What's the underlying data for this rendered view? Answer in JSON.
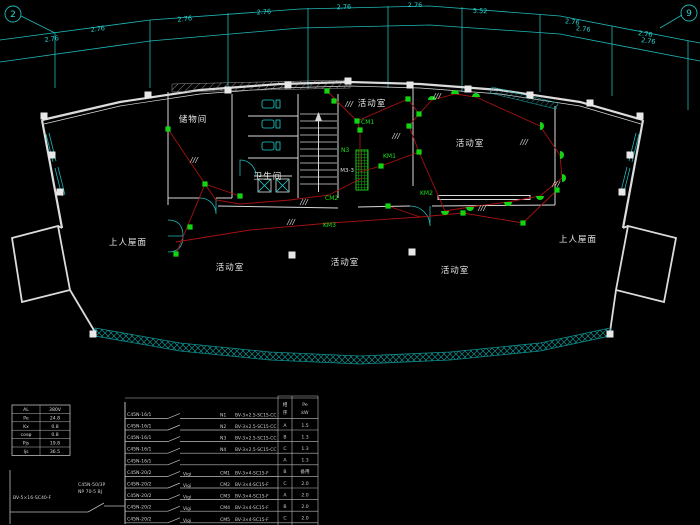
{
  "title": "electrical-floor-plan-cad-drawing",
  "colors": {
    "background": "#000000",
    "walls": "#dcdcdc",
    "dimensions": "#27d3d3",
    "fixtures_and_circuit_labels": "#17e017",
    "wiring": "#a61212",
    "glass_hatch": "#0e8f8f"
  },
  "legend": {
    "ceiling-light-icon": "small green filled square",
    "wall-light-icon": "green filled semicircle",
    "distribution-box-icon": "green hatched rectangle",
    "wire": "red polyline",
    "column-icon": "small white filled square"
  },
  "axes": {
    "left_bubble": "2",
    "right_bubble": "9"
  },
  "dimensions": {
    "upper": [
      {
        "t": "2.76",
        "x": 98,
        "y": 31,
        "r": -8
      },
      {
        "t": "2.76",
        "x": 185,
        "y": 21,
        "r": -6
      },
      {
        "t": "2.76",
        "x": 264,
        "y": 14,
        "r": -4
      },
      {
        "t": "2.76",
        "x": 344,
        "y": 9,
        "r": -2
      },
      {
        "t": "2.76",
        "x": 415,
        "y": 7,
        "r": 0
      },
      {
        "t": "5.52",
        "x": 480,
        "y": 13,
        "r": 3
      },
      {
        "t": "2.76",
        "x": 572,
        "y": 24,
        "r": 6
      },
      {
        "t": "2.76",
        "x": 645,
        "y": 36,
        "r": 8
      }
    ],
    "lower": [
      {
        "t": "2.76",
        "x": 52,
        "y": 41,
        "r": -8
      },
      {
        "t": "2.76",
        "x": 583,
        "y": 31,
        "r": 6
      },
      {
        "t": "2.76",
        "x": 648,
        "y": 43,
        "r": 8
      }
    ]
  },
  "rooms": [
    {
      "name": "storage-room",
      "label": "储物间",
      "x": 193,
      "y": 122
    },
    {
      "name": "bathroom",
      "label": "卫生间",
      "x": 268,
      "y": 179
    },
    {
      "name": "activity-room-1",
      "label": "活动室",
      "x": 372,
      "y": 106
    },
    {
      "name": "activity-room-2",
      "label": "活动室",
      "x": 470,
      "y": 146
    },
    {
      "name": "activity-room-3",
      "label": "活动室",
      "x": 230,
      "y": 270
    },
    {
      "name": "activity-room-4",
      "label": "活动室",
      "x": 345,
      "y": 265
    },
    {
      "name": "activity-room-5",
      "label": "活动室",
      "x": 455,
      "y": 273
    },
    {
      "name": "roof-terrace-left",
      "label": "上人屋面",
      "x": 128,
      "y": 245
    },
    {
      "name": "roof-terrace-right",
      "label": "上人屋面",
      "x": 578,
      "y": 242
    }
  ],
  "plan_circuit_labels": [
    {
      "label": "CM1",
      "x": 361,
      "y": 124
    },
    {
      "label": "KM1",
      "x": 383,
      "y": 158
    },
    {
      "label": "N3",
      "x": 341,
      "y": 152
    },
    {
      "label": "KM2",
      "x": 420,
      "y": 195
    },
    {
      "label": "CM2",
      "x": 325,
      "y": 200
    },
    {
      "label": "KM3",
      "x": 323,
      "y": 227
    }
  ],
  "panel_box_label": "M3-3",
  "load_table": {
    "rows": [
      [
        "AL",
        "380V"
      ],
      [
        "Pe",
        "24.8"
      ],
      [
        "Kx",
        "0.8"
      ],
      [
        "cosφ",
        "0.8"
      ],
      [
        "Pjs",
        "19.8"
      ],
      [
        "Ijs",
        "36.5"
      ]
    ]
  },
  "panel_schedule": {
    "main_breaker_line1": "C45N-50/3P",
    "main_breaker_line2": "NP 70-5 BJ",
    "incoming_cable": "BV-5×16-SC40-F",
    "header_phase_1": "相",
    "header_phase_2": "序",
    "header_pe": "Pe",
    "header_pe_unit": "kW",
    "branches": [
      {
        "breaker": "C45N-16/1",
        "rcd": "",
        "id": "N1",
        "wire": "BV-3×2.5-SC15-CC",
        "phase": "A",
        "pe": "1.5"
      },
      {
        "breaker": "C45N-16/1",
        "rcd": "",
        "id": "N2",
        "wire": "BV-3×2.5-SC15-CC",
        "phase": "B",
        "pe": "1.3"
      },
      {
        "breaker": "C45N-16/1",
        "rcd": "",
        "id": "N3",
        "wire": "BV-3×2.5-SC15-CC",
        "phase": "C",
        "pe": "1.3"
      },
      {
        "breaker": "C45N-16/1",
        "rcd": "",
        "id": "N4",
        "wire": "BV-3×2.5-SC15-CC",
        "phase": "A",
        "pe": "1.3"
      },
      {
        "breaker": "C45N-16/1",
        "rcd": "",
        "id": "",
        "wire": "",
        "phase": "B",
        "pe": "备用"
      },
      {
        "breaker": "C45N-20/2",
        "rcd": "Vigi",
        "id": "CM1",
        "wire": "BV-3×4-SC15-F",
        "phase": "C",
        "pe": "2.0"
      },
      {
        "breaker": "C45N-20/2",
        "rcd": "Vigi",
        "id": "CM2",
        "wire": "BV-3×4-SC15-F",
        "phase": "A",
        "pe": "2.0"
      },
      {
        "breaker": "C45N-20/2",
        "rcd": "Vigi",
        "id": "CM3",
        "wire": "BV-3×4-SC15-F",
        "phase": "B",
        "pe": "2.0"
      },
      {
        "breaker": "C45N-20/2",
        "rcd": "Vigi",
        "id": "CM4",
        "wire": "BV-3×4-SC15-F",
        "phase": "C",
        "pe": "2.0"
      },
      {
        "breaker": "C45N-20/2",
        "rcd": "Vigi",
        "id": "CM5",
        "wire": "BV-3×4-SC15-F",
        "phase": "A",
        "pe": "2.0"
      }
    ]
  },
  "fixtures": {
    "ceiling": [
      [
        168,
        129
      ],
      [
        205,
        184
      ],
      [
        240,
        196
      ],
      [
        327,
        91
      ],
      [
        334,
        101
      ],
      [
        357,
        121
      ],
      [
        360,
        130
      ],
      [
        408,
        99
      ],
      [
        419,
        114
      ],
      [
        409,
        126
      ],
      [
        419,
        152
      ],
      [
        381,
        166
      ],
      [
        388,
        206
      ],
      [
        463,
        213
      ],
      [
        523,
        223
      ],
      [
        190,
        227
      ],
      [
        176,
        254
      ],
      [
        557,
        190
      ]
    ],
    "wall": [
      [
        432,
        100,
        0
      ],
      [
        455,
        94,
        0
      ],
      [
        476,
        97,
        0
      ],
      [
        540,
        126,
        90
      ],
      [
        560,
        155,
        90
      ],
      [
        562,
        178,
        90
      ],
      [
        540,
        196,
        180
      ],
      [
        508,
        202,
        180
      ],
      [
        470,
        207,
        180
      ],
      [
        445,
        211,
        180
      ]
    ]
  },
  "wires": [
    [
      [
        168,
        129
      ],
      [
        205,
        184
      ],
      [
        176,
        254
      ]
    ],
    [
      [
        205,
        184
      ],
      [
        240,
        196
      ]
    ],
    [
      [
        357,
        121
      ],
      [
        327,
        91
      ]
    ],
    [
      [
        360,
        172
      ],
      [
        360,
        130
      ],
      [
        357,
        121
      ],
      [
        408,
        99
      ],
      [
        419,
        114
      ],
      [
        409,
        126
      ],
      [
        419,
        152
      ],
      [
        381,
        166
      ],
      [
        360,
        172
      ]
    ],
    [
      [
        419,
        114
      ],
      [
        432,
        100
      ],
      [
        455,
        94
      ],
      [
        476,
        97
      ],
      [
        540,
        126
      ],
      [
        560,
        155
      ],
      [
        562,
        178
      ],
      [
        540,
        196
      ],
      [
        508,
        202
      ],
      [
        470,
        207
      ],
      [
        445,
        211
      ],
      [
        419,
        152
      ]
    ],
    [
      [
        362,
        178
      ],
      [
        329,
        195
      ],
      [
        290,
        200
      ],
      [
        240,
        204
      ],
      [
        216,
        200
      ],
      [
        205,
        184
      ]
    ],
    [
      [
        176,
        242
      ],
      [
        250,
        230
      ],
      [
        330,
        223
      ],
      [
        420,
        217
      ],
      [
        463,
        213
      ],
      [
        523,
        223
      ],
      [
        557,
        190
      ]
    ],
    [
      [
        388,
        206
      ],
      [
        420,
        217
      ]
    ]
  ],
  "columns": [
    [
      44,
      116
    ],
    [
      148,
      95
    ],
    [
      228,
      90
    ],
    [
      288,
      85
    ],
    [
      348,
      81
    ],
    [
      410,
      85
    ],
    [
      468,
      89
    ],
    [
      530,
      95
    ],
    [
      590,
      103
    ],
    [
      640,
      116
    ],
    [
      52,
      155
    ],
    [
      60,
      192
    ],
    [
      630,
      155
    ],
    [
      622,
      192
    ],
    [
      292,
      255
    ],
    [
      412,
      252
    ],
    [
      93,
      334
    ],
    [
      610,
      334
    ]
  ],
  "slashes": [
    [
      190,
      160
    ],
    [
      345,
      104
    ],
    [
      392,
      136
    ],
    [
      433,
      96
    ],
    [
      520,
      142
    ],
    [
      552,
      184
    ],
    [
      478,
      208
    ],
    [
      300,
      202
    ],
    [
      287,
      222
    ]
  ]
}
